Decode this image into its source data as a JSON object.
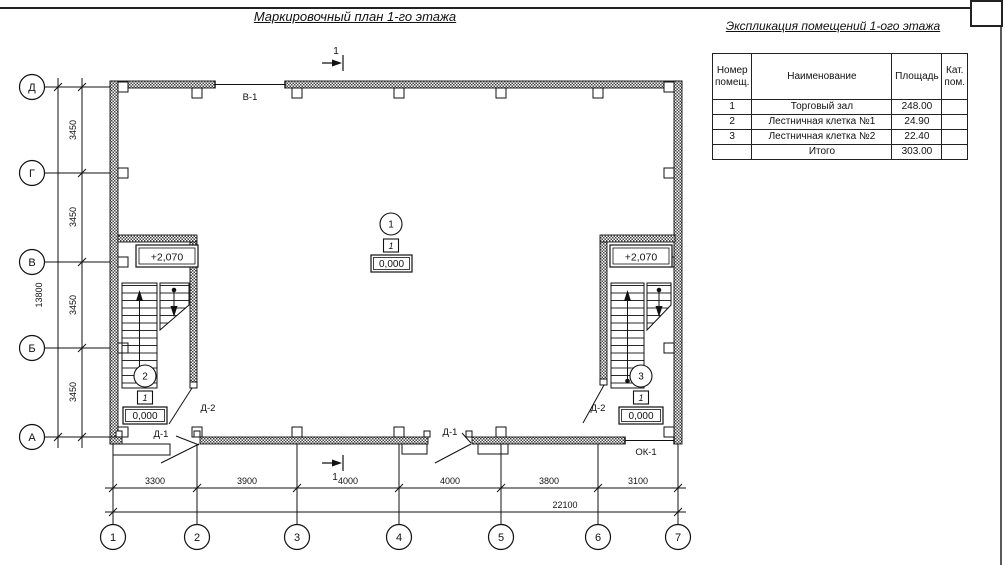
{
  "sheet": {
    "title": "Маркировочный план 1-го этажа"
  },
  "explication": {
    "title": "Экспликация помещений 1-ого этажа",
    "headers": {
      "number": "Номер помещ.",
      "name": "Наименование",
      "area": "Площадь",
      "category": "Кат. пом."
    },
    "rows": [
      {
        "number": "1",
        "name": "Торговый зал",
        "area": "248.00",
        "category": ""
      },
      {
        "number": "2",
        "name": "Лестничная клетка №1",
        "area": "24.90",
        "category": ""
      },
      {
        "number": "3",
        "name": "Лестничная клетка №2",
        "area": "22.40",
        "category": ""
      }
    ],
    "total": {
      "label": "Итого",
      "area": "303.00"
    }
  },
  "plan": {
    "row_axes": [
      "Д",
      "Г",
      "В",
      "Б",
      "А"
    ],
    "col_axes": [
      "1",
      "2",
      "3",
      "4",
      "5",
      "6",
      "7"
    ],
    "v_dims": [
      "3450",
      "3450",
      "3450",
      "3450"
    ],
    "v_total": "13800",
    "h_dims": [
      "3300",
      "3900",
      "4000",
      "4000",
      "3800",
      "3100"
    ],
    "h_total": "22100",
    "section_label": "1",
    "markers": {
      "hall": {
        "number": "1",
        "type": "1",
        "elevation": "0,000"
      },
      "stair1": {
        "number": "2",
        "type": "1",
        "elevation": "0,000",
        "upper_level": "+2,070"
      },
      "stair2": {
        "number": "3",
        "type": "1",
        "elevation": "0,000",
        "upper_level": "+2,070"
      }
    },
    "openings": {
      "window_top": "В-1",
      "window_bottom": "ОК-1",
      "door_exterior": "Д-1",
      "door_interior": "Д-2"
    }
  }
}
